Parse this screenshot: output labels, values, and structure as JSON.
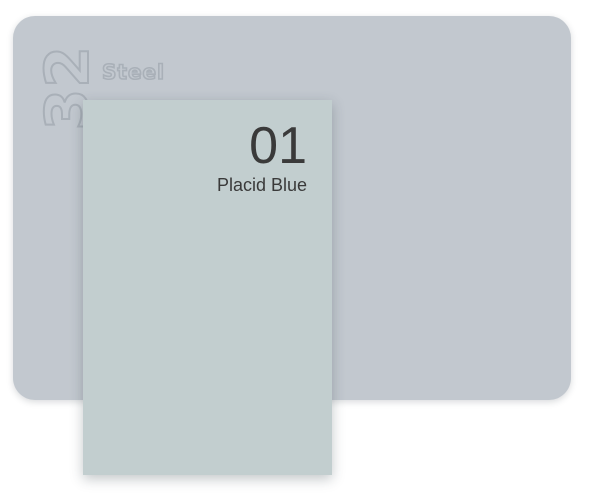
{
  "page": {
    "background_color": "#ffffff"
  },
  "base_card": {
    "number": "32",
    "name": "Steel",
    "color": "#c2c8cf",
    "outline_text_color": "#a9b0b8"
  },
  "swatch_card": {
    "number": "01",
    "name": "Placid Blue",
    "color": "#c2cecf",
    "text_color": "#3a3a3a"
  }
}
